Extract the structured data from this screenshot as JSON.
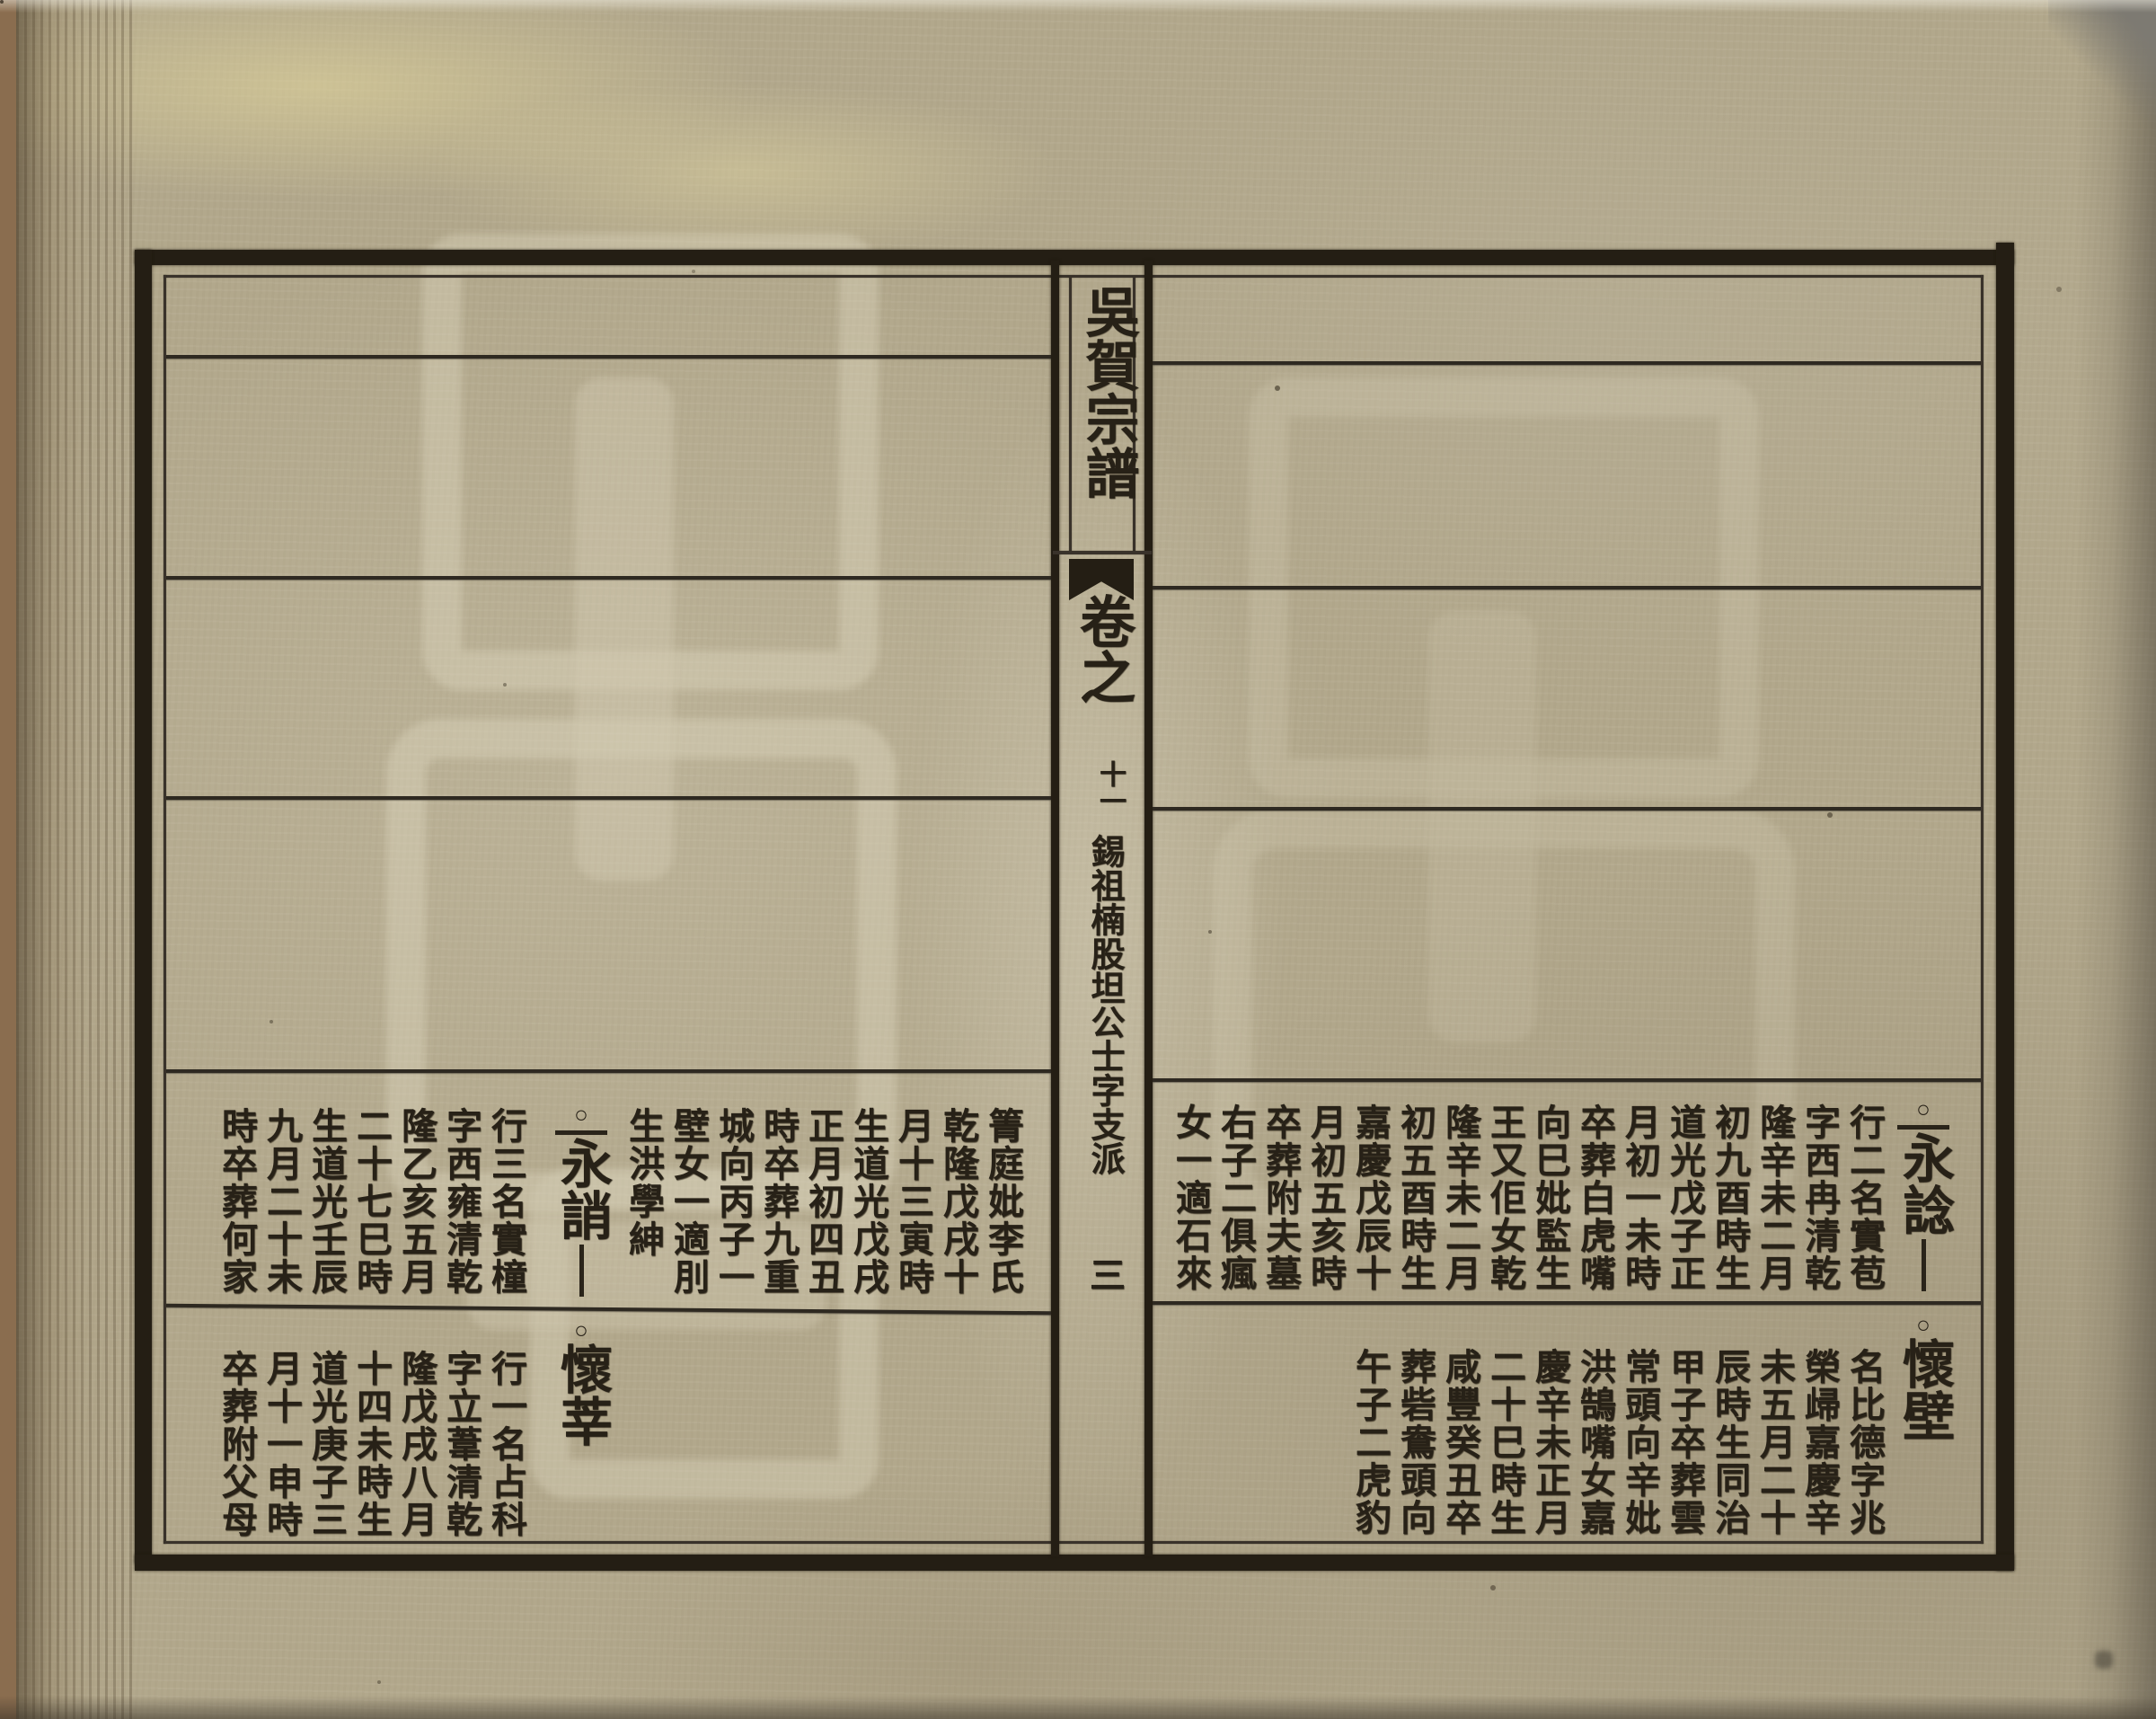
{
  "colors": {
    "paper": "#b2a88c",
    "ink": "#272117",
    "backdrop_wood": "#8a6d4f",
    "stain_yellow": "#e4d89e"
  },
  "spine": {
    "title": "吳賀宗譜",
    "volume_label": "卷之",
    "volume_number": "十一",
    "section_note": "錫祖楠股坦公士字支派",
    "page_number": "三"
  },
  "left_page": {
    "upper_row": {
      "intro_columns": [
        "箐庭妣李氏",
        "乾隆戊戌十",
        "月十三寅時",
        "生道光戊戌",
        "正月初四丑",
        "時卒葬九重",
        "城向丙子一",
        "壁女一適刖",
        "生洪學紳"
      ],
      "marker": "○",
      "name": "永誚",
      "detail_columns": [
        "行三名實橦",
        "字西雍清乾",
        "隆乙亥五月",
        "二十七巳時",
        "生道光壬辰",
        "九月二十未",
        "時卒葬何家"
      ]
    },
    "lower_row": {
      "marker": "○",
      "name": "懷莘",
      "detail_columns": [
        "行一名占科",
        "字立葦清乾",
        "隆戊戌八月",
        "十四未時生",
        "道光庚子三",
        "月十一申時",
        "卒葬附父母"
      ]
    }
  },
  "right_page": {
    "upper_row": {
      "marker": "○",
      "name": "永諗",
      "detail_columns": [
        "行二名實苞",
        "字西冉清乾",
        "隆辛未二月",
        "初九酉時生",
        "道光戊子正",
        "月初一未時",
        "卒葬白虎嘴",
        "向巳妣監生",
        "王又佢女乾",
        "隆辛未二月",
        "初五酉時生",
        "嘉慶戊辰十",
        "月初五亥時",
        "卒葬附夫墓",
        "右子二俱瘋",
        "女一適石來"
      ]
    },
    "lower_row": {
      "marker": "○",
      "name": "懷壁",
      "detail_columns": [
        "名比德字兆",
        "榮㱕嘉慶辛",
        "未五月二十",
        "辰時生同治",
        "甲子卒葬雲",
        "常頭向辛妣",
        "洪鵠嘴女嘉",
        "慶辛未正月",
        "二十巳時生",
        "咸豐癸丑卒",
        "葬砦鴦頭向",
        "午子二虎豹"
      ]
    }
  }
}
